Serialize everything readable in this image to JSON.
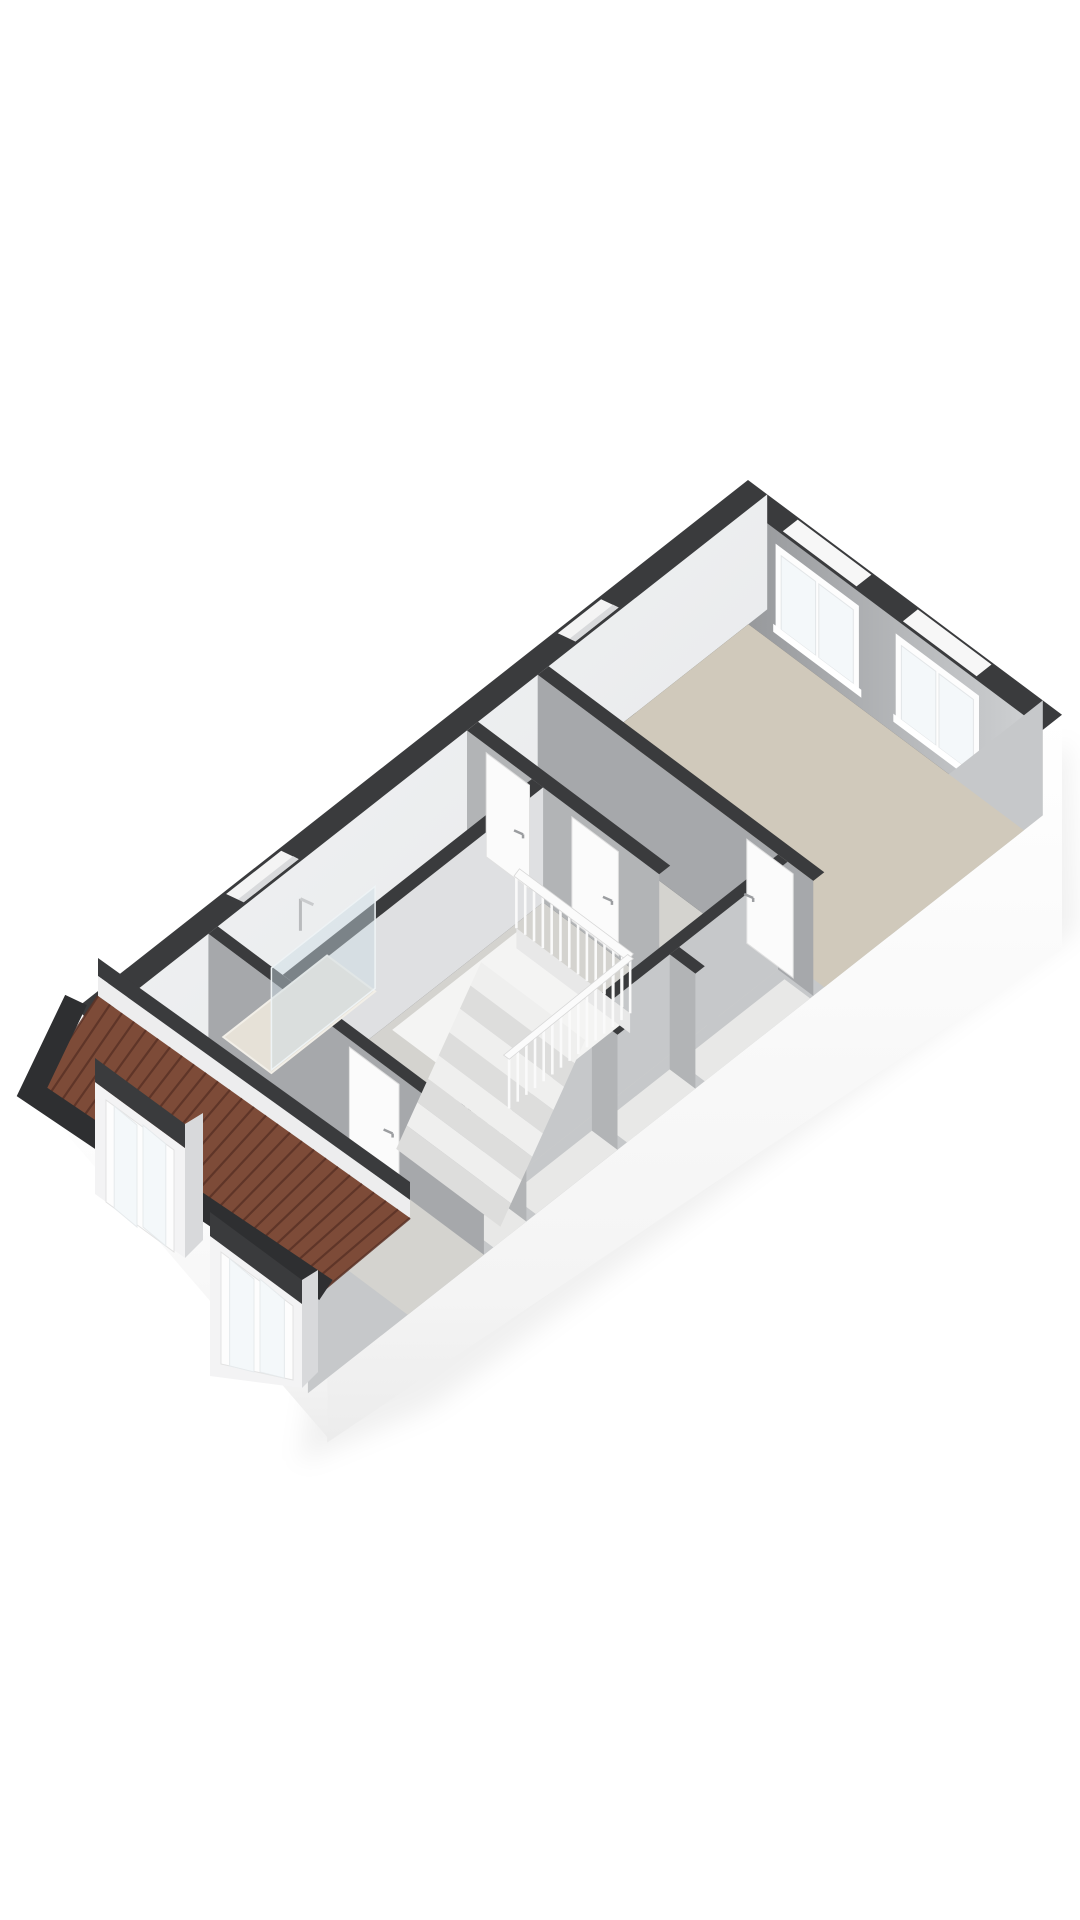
{
  "meta": {
    "title": "3d-floor-plan-render",
    "view": "isometric-top",
    "visible_text": "none"
  },
  "palette": {
    "background": "#ffffff",
    "wall_top": "#3a3b3d",
    "wall_top_dark": "#2e2f31",
    "exterior_skirt": "#fcfcfc",
    "exterior_skirt_shade": "#efefef",
    "interior_face_bright": "#eff0f2",
    "interior_face_light": "#dfe0e2",
    "interior_face_mid": "#c6c8ca",
    "interior_face_gray": "#a6a8ab",
    "interior_face_gray2": "#b2b4b6",
    "floor_beige": "#d0c9bb",
    "floor_beige_light": "#d8d2c6",
    "floor_gray": "#d4d3cf",
    "floor_closet": "#e8e8e7",
    "stair_hole": "#f4f4f3",
    "tread_light": "#efefee",
    "tread_dark": "#dddddc",
    "railing": "#fafafa",
    "glass": "rgba(205,220,228,0.45)",
    "window_frame": "#fdfdfd",
    "window_pane": "#f4f8fa",
    "roof_tile": "#7d4b38",
    "roof_tile_line": "#5a3226",
    "shadow": "rgba(0,0,0,0.06)"
  },
  "projection": {
    "origin": [
      748,
      480
    ],
    "u": [
      0.801,
      0.599
    ],
    "v": [
      -0.786,
      0.618
    ],
    "wall_height": 115,
    "skirt_e": 235,
    "skirt_s": 150
  },
  "plan": {
    "footprint": [
      [
        0,
        0
      ],
      [
        392,
        0
      ],
      [
        392,
        935
      ],
      [
        0,
        854
      ]
    ],
    "rooms": [
      {
        "id": "bedroom-large",
        "rect": [
          24,
          24,
          368,
          278
        ],
        "color": "floor_beige"
      },
      {
        "id": "landing-north",
        "rect": [
          24,
          292,
          324,
          368
        ],
        "color": "floor_gray"
      },
      {
        "id": "landing-south",
        "rect": [
          119,
          382,
          324,
          711
        ],
        "color": "floor_gray"
      },
      {
        "id": "bathroom",
        "rect": [
          24,
          382,
          105,
          699
        ],
        "color": "floor_beige_light"
      },
      {
        "id": "closet-nook",
        "rect": [
          336,
          296,
          368,
          430
        ],
        "color": "floor_closet"
      },
      {
        "id": "closet-1",
        "rect": [
          336,
          442,
          368,
          529
        ],
        "color": "floor_closet"
      },
      {
        "id": "closet-2",
        "rect": [
          336,
          541,
          368,
          645
        ],
        "color": "floor_closet"
      },
      {
        "id": "closet-3",
        "rect": [
          336,
          657,
          368,
          699
        ],
        "color": "floor_closet"
      },
      {
        "id": "bedroom-attic",
        "rect": [
          24,
          711,
          368,
          808
        ],
        "color": "floor_gray"
      }
    ],
    "walls": [
      {
        "id": "wall-bedroom-south",
        "rect": [
          24,
          278,
          368,
          292
        ],
        "face": "b",
        "color": "interior_face_gray"
      },
      {
        "id": "wall-doors-mid",
        "rect": [
          24,
          368,
          264,
          382
        ],
        "face": "b",
        "color": "interior_face_gray2"
      },
      {
        "id": "wall-bath-east",
        "rect": [
          105,
          382,
          119,
          699
        ],
        "face": "a",
        "color": "interior_face_light"
      },
      {
        "id": "wall-closets-west",
        "rect": [
          324,
          292,
          336,
          711
        ],
        "face": "a-",
        "color": "interior_face_mid"
      },
      {
        "id": "wall-closet-cross1",
        "rect": [
          336,
          430,
          368,
          442
        ],
        "face": "b",
        "color": "interior_face_gray2"
      },
      {
        "id": "wall-closet-cross2",
        "rect": [
          336,
          529,
          368,
          541
        ],
        "face": "b",
        "color": "interior_face_gray2"
      },
      {
        "id": "wall-closet-cross3",
        "rect": [
          336,
          645,
          368,
          657
        ],
        "face": "b",
        "color": "interior_face_gray2"
      },
      {
        "id": "wall-attic-north",
        "rect": [
          24,
          699,
          368,
          711
        ],
        "face": "b",
        "color": "interior_face_gray"
      },
      {
        "id": "wall-knee",
        "rect": [
          24,
          808,
          368,
          822
        ],
        "face": "none",
        "color": "interior_face_gray"
      }
    ],
    "ne_windows": [
      {
        "id": "window-ne-1",
        "a1": 58,
        "a2": 162
      },
      {
        "id": "window-ne-2",
        "a1": 208,
        "a2": 312
      }
    ],
    "nw_niches": [
      {
        "id": "window-nw-bedroom",
        "b1": 190,
        "b2": 245
      },
      {
        "id": "window-nw-bathroom",
        "b1": 597,
        "b2": 667
      }
    ],
    "doors": [
      {
        "id": "door-bathroom",
        "wall_b": 382,
        "a1": 48,
        "a2": 102,
        "handle": "right"
      },
      {
        "id": "door-landing",
        "wall_b": 382,
        "a1": 155,
        "a2": 213,
        "handle": "right"
      },
      {
        "id": "door-bedroom-large",
        "wall_b": 292,
        "a1": 285,
        "a2": 343,
        "handle": "left"
      },
      {
        "id": "door-bedroom-attic",
        "wall_b": 711,
        "a1": 200,
        "a2": 262,
        "handle": "right"
      }
    ],
    "stairwell": {
      "hole": [
        123,
        420,
        265,
        578
      ],
      "treads": 8,
      "tread_step": 13.5,
      "tread_drop": 15
    },
    "railing": {
      "edge_b": 420,
      "a1": 123,
      "a2": 265,
      "edge_a": 265,
      "b1": 420,
      "b2": 578,
      "post_gap": 11,
      "height": 57
    },
    "shower": {
      "tray": [
        24,
        560,
        84,
        692
      ],
      "glass_a": 84,
      "head_b": 600
    }
  },
  "roof_screen": {
    "knee_band": [
      [
        98,
        958
      ],
      [
        410,
        1182
      ],
      [
        410,
        1200
      ],
      [
        98,
        976
      ]
    ],
    "knee_face": [
      [
        98,
        976
      ],
      [
        410,
        1200
      ],
      [
        410,
        1218
      ],
      [
        98,
        996
      ]
    ],
    "tiles": [
      [
        98,
        996
      ],
      [
        410,
        1218
      ],
      [
        326,
        1288
      ],
      [
        36,
        1090
      ]
    ],
    "tile_lines": 26,
    "eave_path": [
      [
        76,
        1000
      ],
      [
        32,
        1092
      ],
      [
        326,
        1290
      ]
    ],
    "skirt_sw": [
      [
        32,
        1094
      ],
      [
        326,
        1292
      ],
      [
        328,
        1438
      ]
    ],
    "dormers": [
      {
        "id": "dormer-1",
        "band": [
          [
            95,
            1058
          ],
          [
            185,
            1124
          ],
          [
            185,
            1148
          ],
          [
            95,
            1082
          ]
        ],
        "front": [
          [
            95,
            1082
          ],
          [
            185,
            1148
          ],
          [
            185,
            1258
          ],
          [
            95,
            1194
          ]
        ],
        "side": [
          [
            185,
            1124
          ],
          [
            203,
            1113
          ],
          [
            203,
            1240
          ],
          [
            185,
            1258
          ]
        ],
        "window": [
          [
            106,
            1100
          ],
          [
            174,
            1150
          ],
          [
            174,
            1252
          ],
          [
            106,
            1202
          ]
        ]
      },
      {
        "id": "dormer-2",
        "band": [
          [
            210,
            1212
          ],
          [
            302,
            1280
          ],
          [
            302,
            1304
          ],
          [
            210,
            1236
          ]
        ],
        "front": [
          [
            210,
            1236
          ],
          [
            302,
            1304
          ],
          [
            302,
            1388
          ],
          [
            210,
            1376
          ]
        ],
        "side": [
          [
            302,
            1280
          ],
          [
            318,
            1270
          ],
          [
            318,
            1372
          ],
          [
            302,
            1388
          ]
        ],
        "window": [
          [
            221,
            1252
          ],
          [
            293,
            1306
          ],
          [
            293,
            1380
          ],
          [
            221,
            1364
          ]
        ]
      }
    ]
  }
}
